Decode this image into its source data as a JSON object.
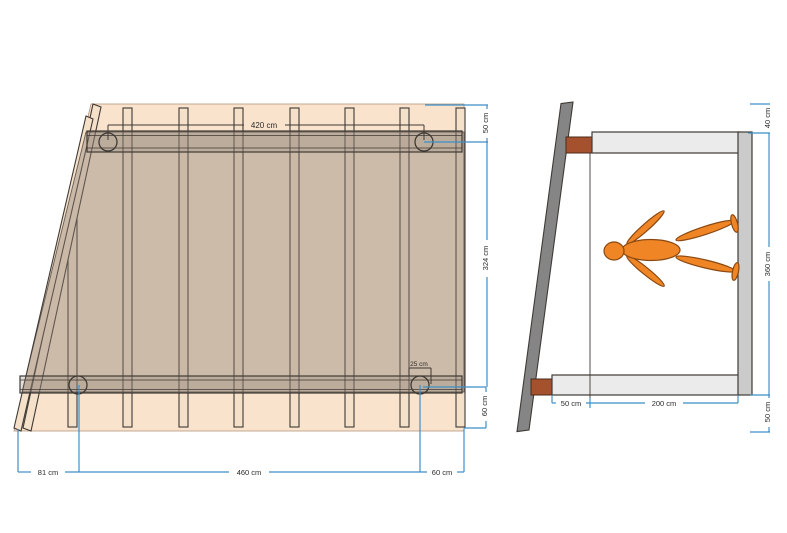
{
  "colors": {
    "dimension-blue": "#3E8EC7",
    "outline-dark": "#3F3A35",
    "roof-tan": "#F9E3CC",
    "tan-edge": "#B0937A",
    "wood-tan": "#F5E0C9",
    "panel-gray": "#8D8075",
    "wall-gray": "#858585",
    "bracket-brown": "#A6512E",
    "bracket-edge": "#4A2A18",
    "beam-light": "#EBEBEB",
    "post-gray": "#CBCBCB",
    "figure-orange": "#EF8524",
    "figure-edge": "#8A4812",
    "label-dark": "#2B2B2B"
  },
  "plan_view": {
    "dims": {
      "top_span": "420 cm",
      "post_offset": "25 cm",
      "right_top": "50 cm",
      "right_middle": "324 cm",
      "right_bottom": "60 cm",
      "bottom_left": "81 cm",
      "bottom_middle": "460 cm",
      "bottom_right": "60 cm"
    }
  },
  "side_view": {
    "dims": {
      "right_top": "40 cm",
      "right_middle": "360 cm",
      "right_bottom": "50 cm",
      "bottom_left": "50 cm",
      "bottom_middle": "200 cm"
    }
  }
}
